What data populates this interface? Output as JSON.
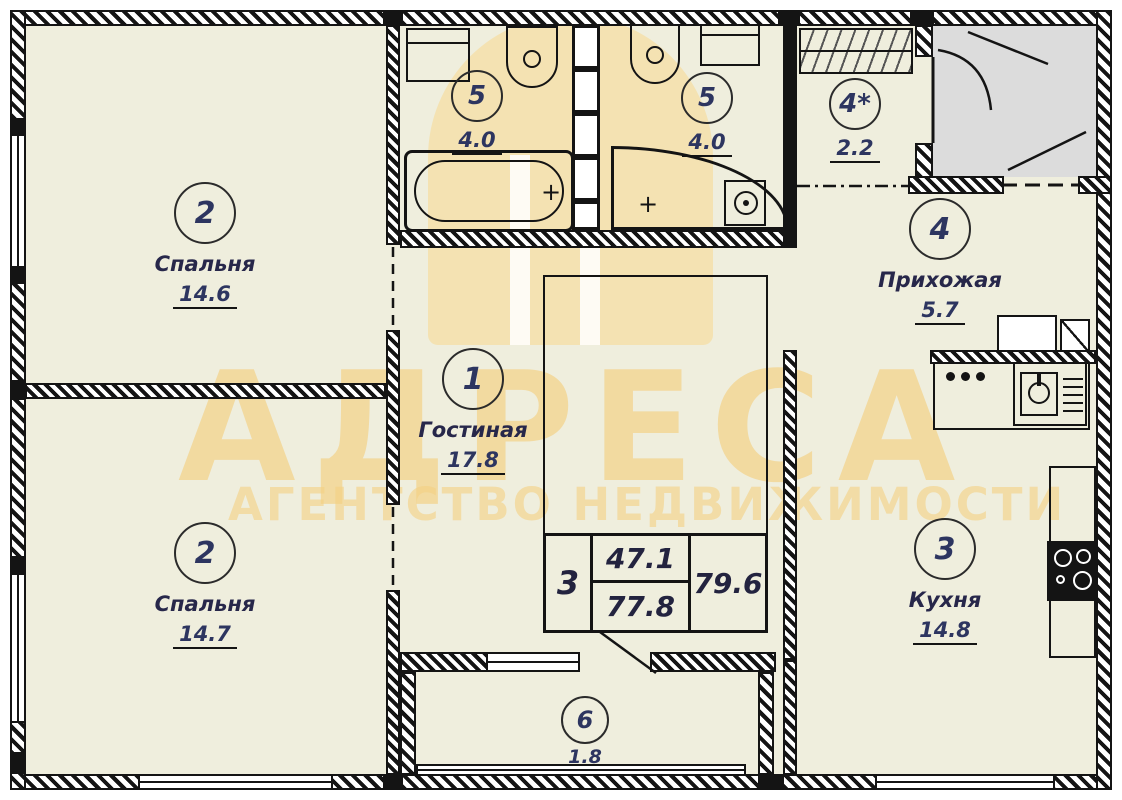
{
  "watermark": {
    "title": "АДРЕСА",
    "subtitle": "АГЕНТСТВО НЕДВИЖИМОСТИ"
  },
  "rooms": {
    "living": {
      "number": "1",
      "name": "Гостиная",
      "area": "17.8"
    },
    "bedroom_top": {
      "number": "2",
      "name": "Спальня",
      "area": "14.6"
    },
    "bedroom_bottom": {
      "number": "2",
      "name": "Спальня",
      "area": "14.7"
    },
    "kitchen": {
      "number": "3",
      "name": "Кухня",
      "area": "14.8"
    },
    "hallway": {
      "number": "4",
      "name": "Прихожая",
      "area": "5.7"
    },
    "closet": {
      "number": "4*",
      "area": "2.2"
    },
    "bathroom_left": {
      "number": "5",
      "area": "4.0"
    },
    "bathroom_right": {
      "number": "5",
      "area": "4.0"
    },
    "balcony": {
      "number": "6",
      "area": "1.8"
    }
  },
  "stamp": {
    "rooms_count": "3",
    "living_area": "47.1",
    "total_area": "77.8",
    "total_with_summer": "79.6"
  },
  "fixtures": {
    "tub_faucet_symbol": "+",
    "shower_faucet_symbol": "+"
  },
  "colors": {
    "floor": "#efeedd",
    "watermark_orange": "#f3cd7a",
    "lobby_gray": "#dcdcdc",
    "wall": "#141414"
  }
}
